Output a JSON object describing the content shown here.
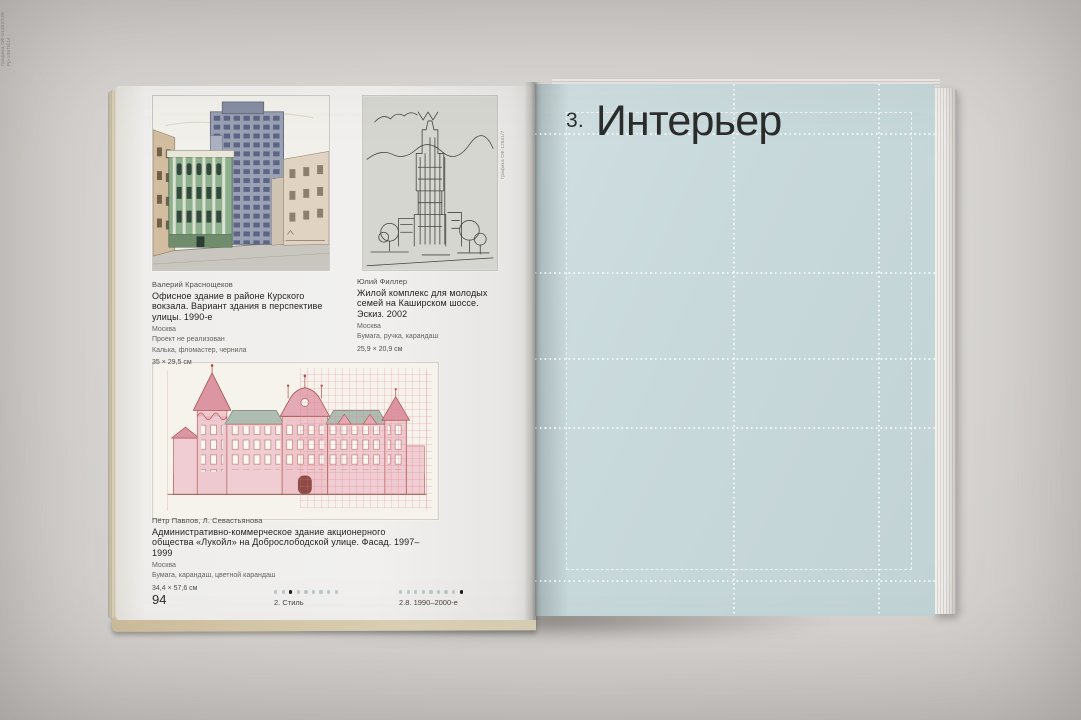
{
  "left_page": {
    "figures": [
      {
        "artist": "Валерий Краснощеков",
        "title": "Офисное здание в районе Курского вокзала. Вариант здания в перспективе улицы. 1990-е",
        "city": "Москва",
        "note": "Проект не реализован",
        "media": "Калька, фломастер, чернила",
        "size": "35 × 29,5 см"
      },
      {
        "artist": "Юлий Филлер",
        "title": "Жилой комплекс для молодых семей на Каширском шоссе. Эскиз. 2002",
        "city": "Москва",
        "media": "Бумага, ручка, карандаш",
        "size": "25,9 × 20,9 см",
        "inventory": "Графика ОФ-12841/7"
      },
      {
        "artist": "Пётр Павлов, Л. Севастьянова",
        "title": "Административно-коммерческое здание акционерного общества «Лукойл» на Доброслободской улице. Фасад. 1997–1999",
        "city": "Москва",
        "media": "Бумага, карандаш, цветной карандаш",
        "size": "34,4 × 57,6 см",
        "inventory": "Графика ОФ-51452/126",
        "inventory2": "Рр-1097/б14"
      }
    ],
    "footer": {
      "page_number": "94",
      "chapter": {
        "label": "2. Стиль",
        "dots_total": 9,
        "dots_active": 3
      },
      "section": {
        "label": "2.8. 1990–2000-е",
        "dots_total": 9,
        "dots_active": 9
      }
    }
  },
  "right_page": {
    "chapter_number": "3.",
    "chapter_title": "Интерьер"
  },
  "colors": {
    "backdrop": "#d5d2cf",
    "left_page_paper": "#efeeec",
    "right_page": "#c6d7d9",
    "grid_line": "#fafdfd",
    "title_text": "#2b2d2c",
    "dot_active": "#1a1a1a",
    "dot_inactive": "#b9c7ca"
  }
}
